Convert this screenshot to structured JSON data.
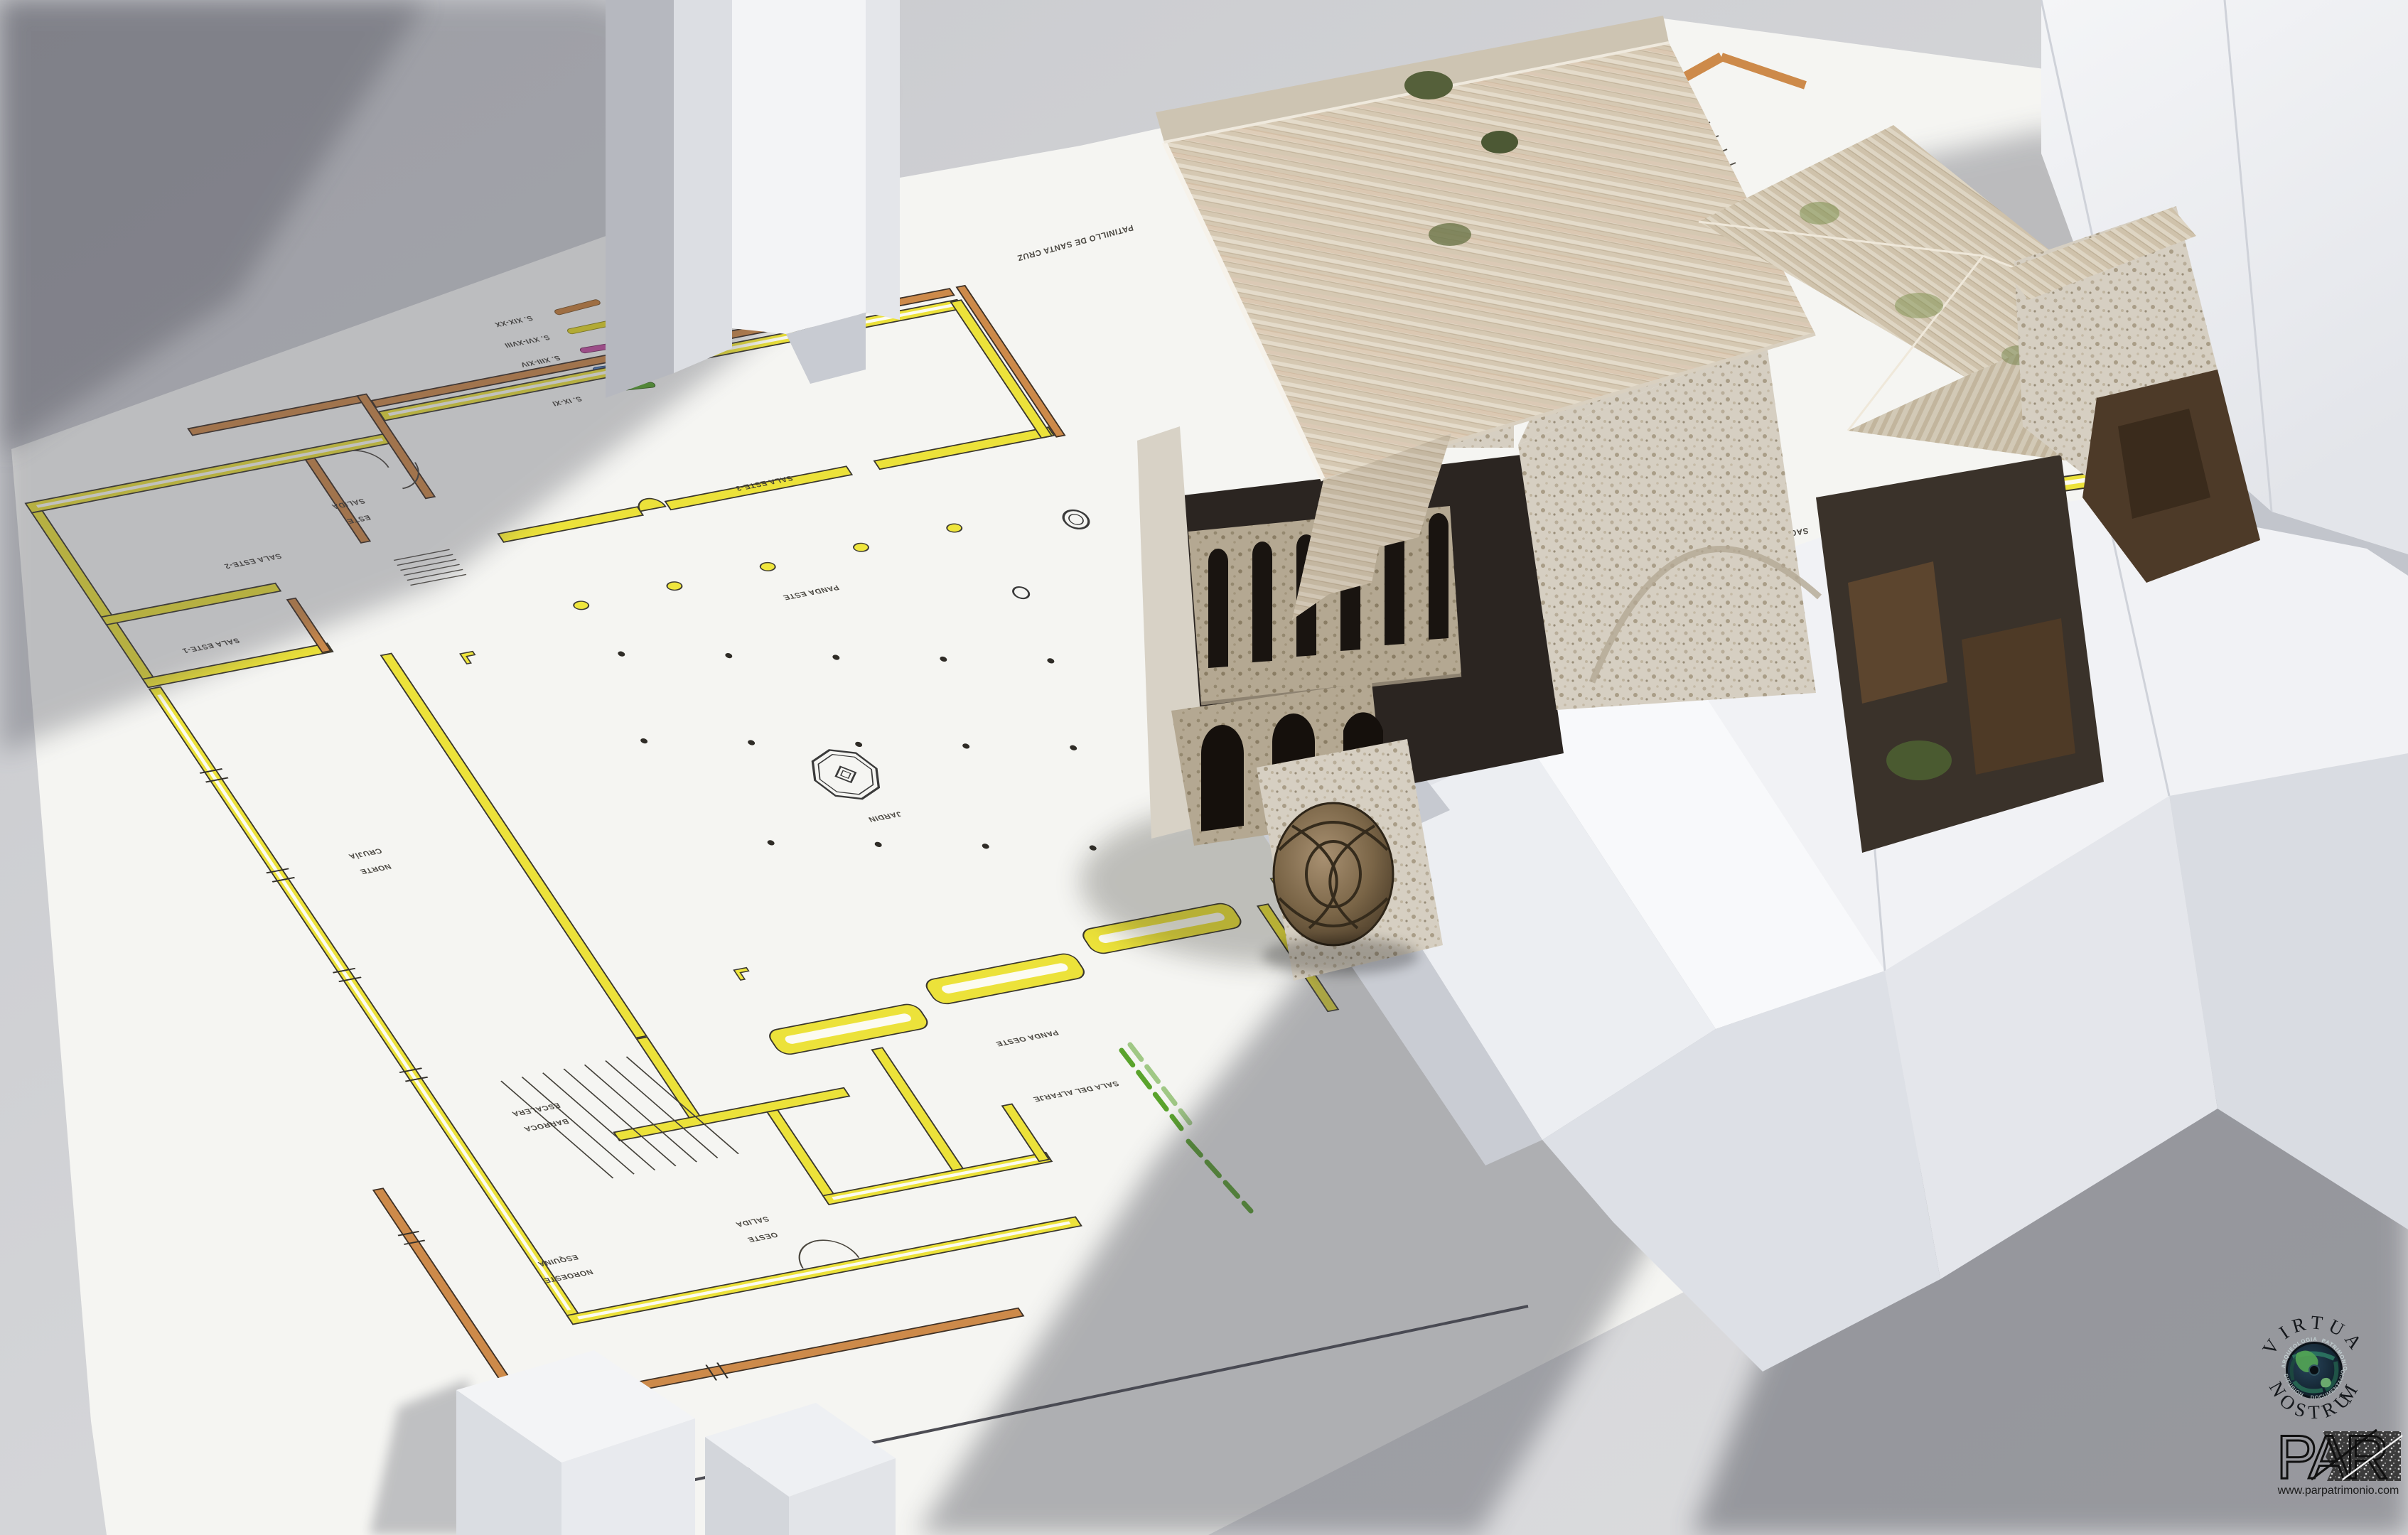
{
  "scene": {
    "type": "3d-architectural-visualization",
    "background_color": "#d2d3d6",
    "sheet_color": "#f5f5f2"
  },
  "plan": {
    "legend": [
      {
        "label": "S. XIX-XX",
        "color": "#c9803b"
      },
      {
        "label": "S. XVI-XVIII",
        "color": "#e6da25"
      },
      {
        "label": "S. XIII-XIV",
        "color": "#c4509f"
      },
      {
        "label": "S. XIII",
        "color": "#4d7cbf"
      },
      {
        "label": "S. IX-XI",
        "color": "#57a32b"
      }
    ],
    "labels": {
      "salida_este": [
        "SALIDA",
        "ESTE"
      ],
      "sala_este_2": [
        "SALA ESTE-2"
      ],
      "sala_este_1": [
        "SALA ESTE-1"
      ],
      "sala_este_3": [
        "SALA ESTE-3"
      ],
      "panda_este": [
        "PANDA ESTE"
      ],
      "jardin": [
        "JARDIN"
      ],
      "crujia_norte": [
        "CRUJÍA",
        "NORTE"
      ],
      "panda_oeste": [
        "PANDA OESTE"
      ],
      "escalera_barroca": [
        "ESCALERA",
        "BARROCA"
      ],
      "esquina_noroeste": [
        "ESQUINA",
        "NOROESTE"
      ],
      "salida_oeste": [
        "SALIDA",
        "OESTE"
      ],
      "sala_del_alfarje": [
        "SALA DEL ALFARJE"
      ],
      "sacristia": [
        "SACRISTÍA"
      ],
      "patinillo_santa_cruz": [
        "PATINILLO DE SANTA CRUZ"
      ],
      "edificio_almacen": [
        "EDIFICIO ALMACEN"
      ],
      "partial_occluded": [
        "CAS",
        "CA"
      ]
    },
    "wall_colors": {
      "yellow": "#ece23a",
      "orange": "#cd8a4a",
      "green": "#5aa32c"
    }
  },
  "logos": {
    "virtua_nostrum": {
      "arc_top_initial": "V",
      "arc_top_rest": "IRTUA",
      "arc_bottom_rest": "NOSTRU",
      "arc_bottom_last": "M",
      "ring_words": [
        "ARQUEOLOGIA",
        "PATRIMONIO",
        "DIFUSION",
        "DOCUMENTACION"
      ],
      "accent_color": "#2f62d9"
    },
    "par": {
      "wordmark": "PAR",
      "url": "www.parpatrimonio.com"
    }
  }
}
